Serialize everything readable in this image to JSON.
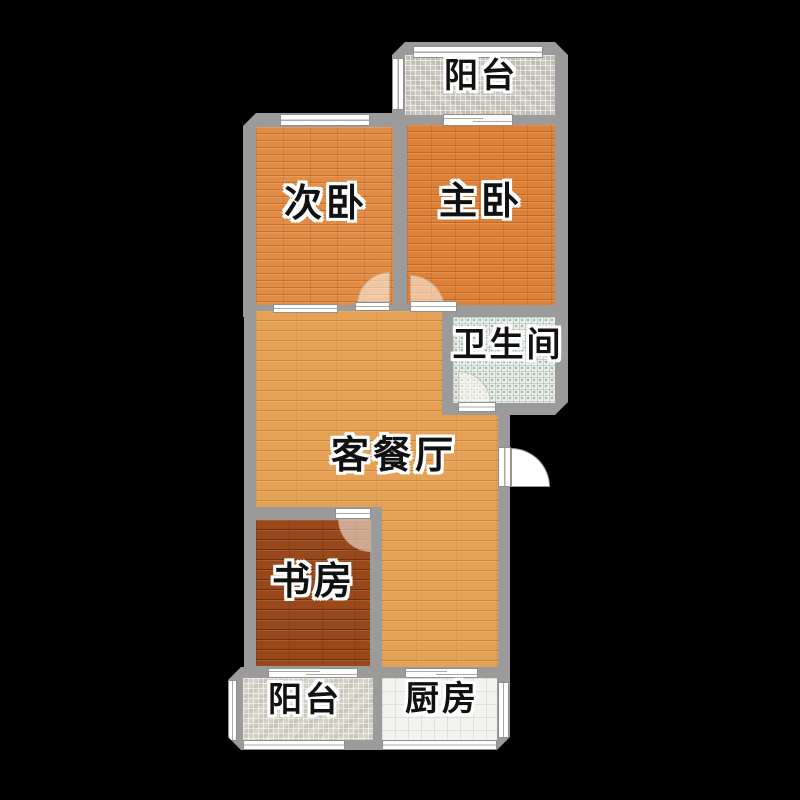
{
  "plan": {
    "type": "apartment-floor-plan",
    "background": "black"
  },
  "rooms": [
    {
      "id": "balcony-top",
      "label": "阳台",
      "floor": "gray-mosaic-tile"
    },
    {
      "id": "second-bedroom",
      "label": "次卧",
      "floor": "orange-wood-plank"
    },
    {
      "id": "master-bedroom",
      "label": "主卧",
      "floor": "orange-wood-plank"
    },
    {
      "id": "bathroom",
      "label": "卫生间",
      "floor": "light-green-tile"
    },
    {
      "id": "living-dining",
      "label": "客餐厅",
      "floor": "light-orange-wood-plank"
    },
    {
      "id": "study",
      "label": "书房",
      "floor": "dark-brown-wood-plank"
    },
    {
      "id": "balcony-bottom",
      "label": "阳台",
      "floor": "beige-mosaic-tile"
    },
    {
      "id": "kitchen",
      "label": "厨房",
      "floor": "white-tile"
    }
  ],
  "colors": {
    "background": "#000000",
    "wall": "#9b9b9b",
    "wood-second": "#e28c45",
    "wood-master": "#dd8138",
    "wood-living": "#e5a257",
    "wood-study": "#98481b",
    "tile-balcony-top": "#cbc8bf",
    "tile-balcony-bottom": "#d5d1c6",
    "tile-bathroom": "#edf1ed",
    "tile-kitchen": "#f3f3ef",
    "window-fill": "#ffffff",
    "window-border": "#8f8f8f",
    "label-text": "#111111"
  }
}
